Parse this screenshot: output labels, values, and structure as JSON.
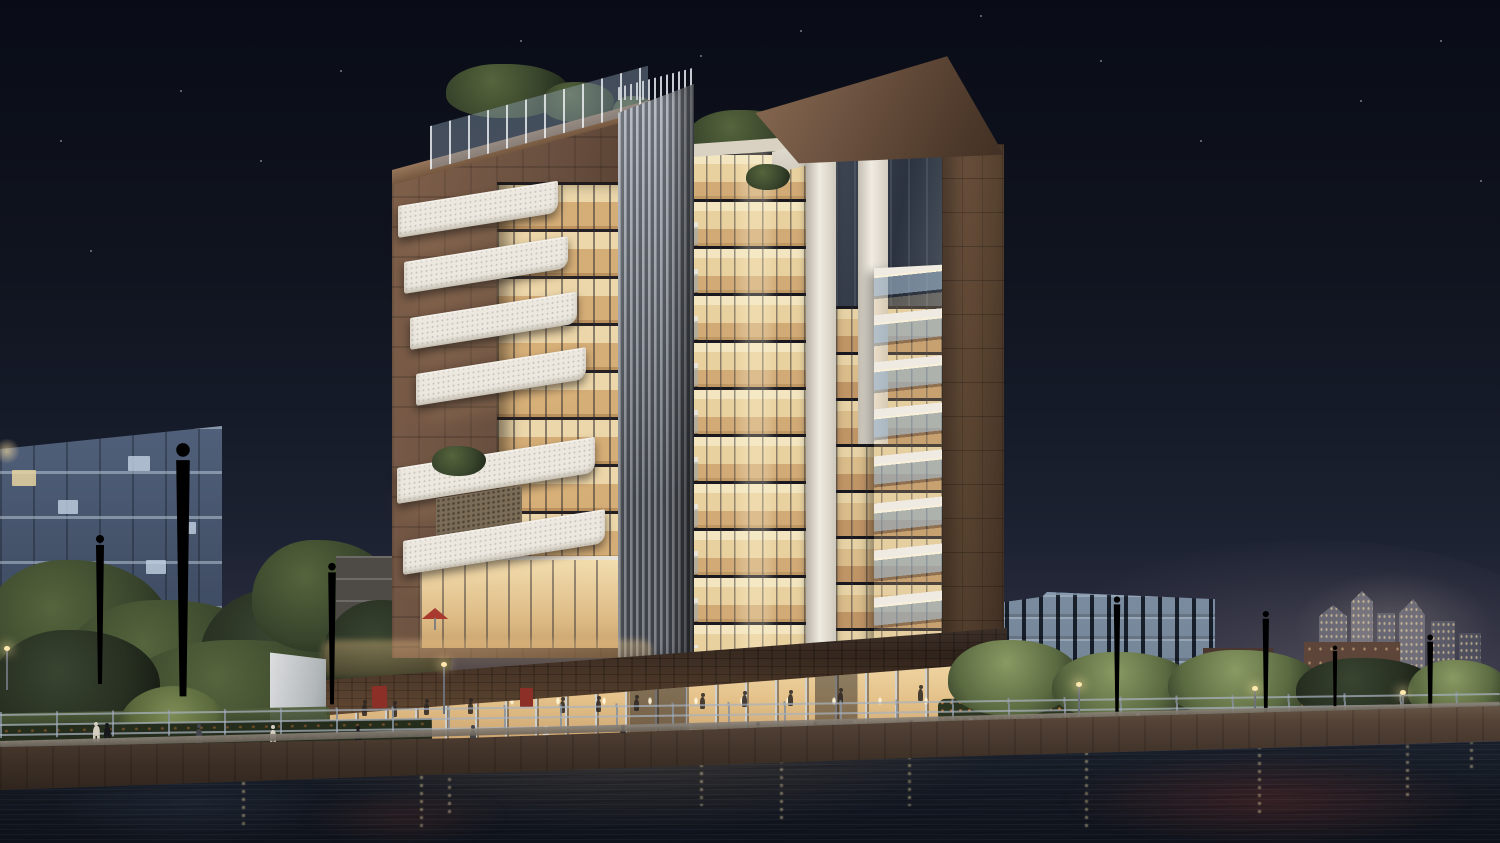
{
  "scene": {
    "description": "Night-time architectural rendering of a modern waterfront apartment building with warmly lit glass facades, stone portal frames, white cantilevered balconies, a vertical louver column, rooftop gardens, a palm-lined canal promenade with pedestrians, background city buildings and light reflections in dark water",
    "time_of_day": "night",
    "palette": {
      "skyTop": "#090c16",
      "skyMid": "#1d2232",
      "skyHorizon": "#3a3a4c",
      "starWhite": "#cfd6e4",
      "stoneLight": "#8a6a50",
      "stone": "#6b5140",
      "stoneDark": "#4a372a",
      "stoneShadow": "#342619",
      "slabWhite": "#f2efe8",
      "glassWarm": "#e7cf9d",
      "glassBright": "#f5e6bd",
      "glassAmber": "#c9a26e",
      "glassCool": "#9fb4c6",
      "glassDark": "#2e3540",
      "louverLight": "#b3b8c0",
      "louverDark": "#555b64",
      "whitePier": "#efeae0",
      "palmLit": "#a2b054",
      "palmMid": "#78873f",
      "palmDark": "#4c5a2c",
      "trunk": "#3c2b1f",
      "trunkLight": "#64482f",
      "treeLight": "#55653c",
      "treeMid": "#39452c",
      "treeDark": "#232b1d",
      "hedge": "#29321f",
      "flower": "#e08237",
      "bgFacade": "#4b5870",
      "bgGlassBlue": "#3c4f63",
      "bgBrick": "#5c453a",
      "cityTower": "#8a8a92",
      "railing": "#a7afba",
      "lampGlow": "#ffe8ad",
      "fascia": "#3a2b21",
      "quayLight": "#6a5849",
      "quayDark": "#2d231c",
      "waterTop": "#232a36",
      "waterDeep": "#0f131c",
      "reflWarm": "#d8a468",
      "reflRed": "#96392a",
      "umbrella": "#a83a2f",
      "peopleDark": "#17181c",
      "peopleLight": "#d5cfc2",
      "peopleMid": "#43454c"
    },
    "stars": [
      [
        520,
        40
      ],
      [
        800,
        30
      ],
      [
        1100,
        60
      ],
      [
        180,
        90
      ],
      [
        60,
        140
      ],
      [
        1360,
        100
      ],
      [
        980,
        15
      ],
      [
        700,
        55
      ],
      [
        260,
        160
      ],
      [
        1440,
        40
      ],
      [
        90,
        250
      ],
      [
        1480,
        180
      ],
      [
        340,
        70
      ],
      [
        1200,
        140
      ]
    ],
    "palms": [
      {
        "x": 183,
        "y": 452,
        "s": 1.7,
        "dark": false
      },
      {
        "x": 100,
        "y": 540,
        "s": 1.0,
        "dark": false
      },
      {
        "x": -18,
        "y": 505,
        "s": 0.95,
        "dark": false
      },
      {
        "x": 332,
        "y": 568,
        "s": 0.95,
        "dark": false
      },
      {
        "x": 1117,
        "y": 600,
        "s": 0.8,
        "dark": false
      },
      {
        "x": 1266,
        "y": 615,
        "s": 0.78,
        "dark": false
      },
      {
        "x": 1430,
        "y": 638,
        "s": 0.72,
        "dark": false
      },
      {
        "x": 1335,
        "y": 648,
        "s": 0.55,
        "dark": true
      }
    ],
    "lamps": [
      [
        443,
        666,
        48
      ],
      [
        1078,
        686,
        34
      ],
      [
        1254,
        690,
        30
      ],
      [
        1402,
        694,
        26
      ],
      [
        6,
        650,
        40
      ]
    ],
    "promenade_people": [
      [
        93,
        742,
        1
      ],
      [
        104,
        743,
        0
      ],
      [
        196,
        744,
        2
      ],
      [
        270,
        745,
        1
      ],
      [
        355,
        745,
        0
      ],
      [
        470,
        744,
        2
      ],
      [
        543,
        745,
        1
      ],
      [
        620,
        743,
        0
      ],
      [
        688,
        742,
        1
      ],
      [
        755,
        740,
        0
      ],
      [
        812,
        739,
        2
      ],
      [
        852,
        738,
        1
      ],
      [
        908,
        737,
        0
      ],
      [
        968,
        735,
        1
      ],
      [
        1048,
        733,
        0
      ],
      [
        1090,
        731,
        2
      ],
      [
        1135,
        730,
        1
      ],
      [
        1185,
        729,
        0
      ],
      [
        1248,
        728,
        1
      ],
      [
        1292,
        727,
        0
      ],
      [
        1338,
        726,
        2
      ],
      [
        1362,
        725,
        1
      ],
      [
        1458,
        722,
        0
      ],
      [
        1475,
        721,
        2
      ]
    ],
    "interior_people": [
      [
        362,
        716
      ],
      [
        392,
        717
      ],
      [
        424,
        715
      ],
      [
        468,
        714
      ],
      [
        560,
        713
      ],
      [
        596,
        712
      ],
      [
        634,
        711
      ],
      [
        700,
        709
      ],
      [
        742,
        707
      ],
      [
        788,
        706
      ],
      [
        838,
        704
      ],
      [
        918,
        701
      ],
      [
        962,
        699
      ]
    ],
    "light_streaks": [
      [
        242,
        782,
        46
      ],
      [
        420,
        768,
        64
      ],
      [
        448,
        762,
        56
      ],
      [
        700,
        756,
        50
      ],
      [
        780,
        752,
        68
      ],
      [
        908,
        748,
        58
      ],
      [
        1085,
        744,
        86
      ],
      [
        1258,
        746,
        72
      ],
      [
        1406,
        737,
        60
      ],
      [
        1470,
        733,
        40
      ]
    ],
    "bg_lit_windows": [
      [
        12,
        470,
        24,
        16,
        0
      ],
      [
        58,
        500,
        20,
        14,
        1
      ],
      [
        128,
        456,
        22,
        15,
        1
      ],
      [
        38,
        586,
        22,
        15,
        0
      ],
      [
        146,
        560,
        20,
        14,
        1
      ],
      [
        86,
        620,
        24,
        15,
        0
      ],
      [
        178,
        522,
        18,
        12,
        1
      ]
    ]
  }
}
